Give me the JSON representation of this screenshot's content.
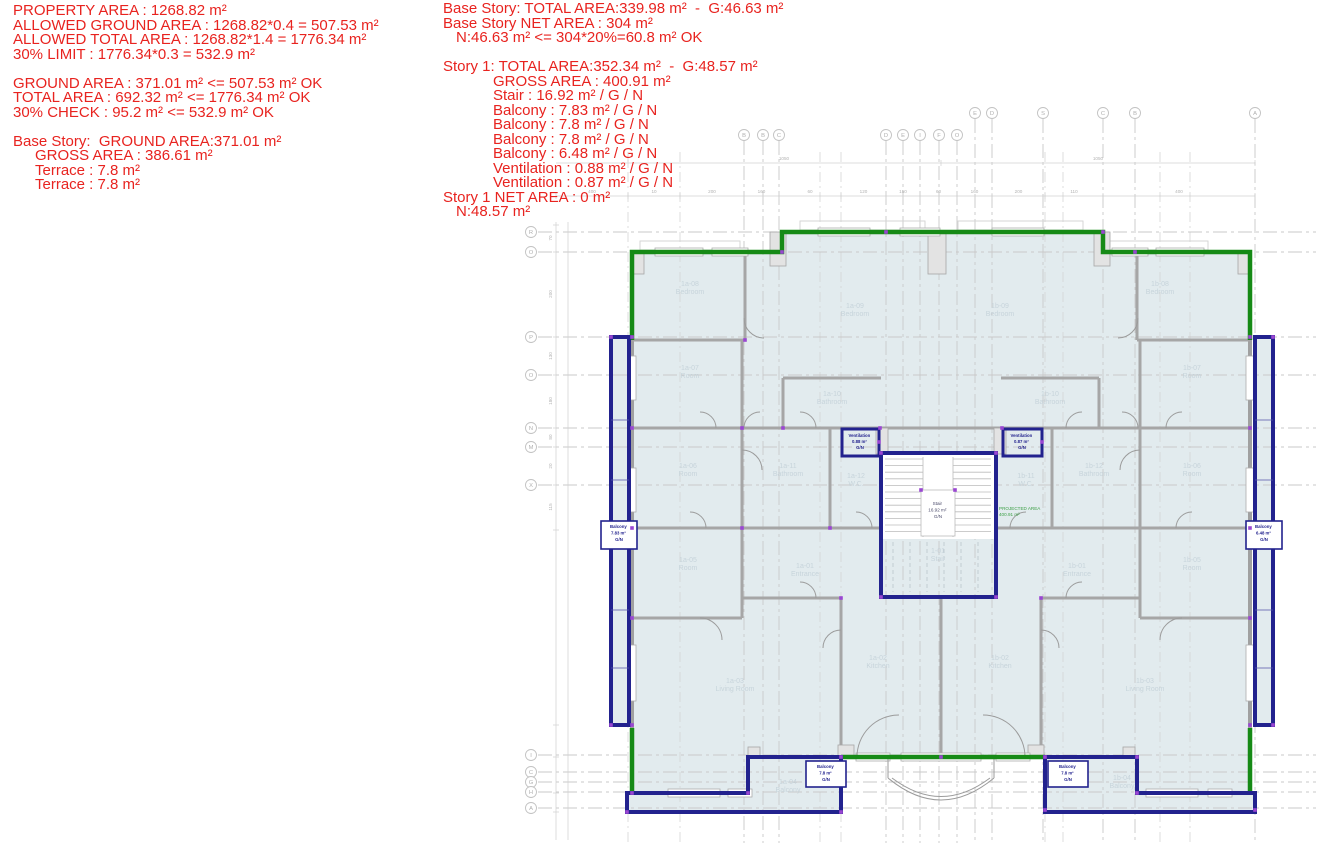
{
  "colors": {
    "red_text": "#e8231f",
    "outline_green": "#168a16",
    "outline_navy": "#22228e",
    "room_fill": "#e2ebee",
    "wall_gray": "#a3a3a3",
    "grid_gray": "#c9c9c9",
    "room_label": "#c7d4db",
    "grip_purple": "#9a46d2",
    "projected_green": "#3da047"
  },
  "calc_left": {
    "lines": [
      {
        "t": "PROPERTY AREA : 1268.82 m²",
        "i": 0
      },
      {
        "t": "ALLOWED GROUND AREA : 1268.82*0.4 = 507.53 m²",
        "i": 0
      },
      {
        "t": "ALLOWED TOTAL AREA : 1268.82*1.4 = 1776.34 m²",
        "i": 0
      },
      {
        "t": "30% LIMIT : 1776.34*0.3 = 532.9 m²",
        "i": 0
      },
      {
        "t": "",
        "i": 0
      },
      {
        "t": "GROUND AREA : 371.01 m² <= 507.53 m² OK",
        "i": 0
      },
      {
        "t": "TOTAL AREA : 692.32 m² <= 1776.34 m² OK",
        "i": 0
      },
      {
        "t": "30% CHECK : 95.2 m² <= 532.9 m² OK",
        "i": 0
      },
      {
        "t": "",
        "i": 0
      },
      {
        "t": "Base Story:  GROUND AREA:371.01 m²",
        "i": 0
      },
      {
        "t": "GROSS AREA : 386.61 m²",
        "i": 1
      },
      {
        "t": "Terrace : 7.8 m²",
        "i": 1
      },
      {
        "t": "Terrace : 7.8 m²",
        "i": 1
      }
    ]
  },
  "calc_right": {
    "lines": [
      {
        "t": "Base Story: TOTAL AREA:339.98 m²  -  G:46.63 m²",
        "i": 0
      },
      {
        "t": "Base Story NET AREA : 304 m²",
        "i": 0
      },
      {
        "t": "N:46.63 m² <= 304*20%=60.8 m² OK",
        "i": 1
      },
      {
        "t": "",
        "i": 0
      },
      {
        "t": "Story 1: TOTAL AREA:352.34 m²  -  G:48.57 m²",
        "i": 0
      },
      {
        "t": "GROSS AREA : 400.91 m²",
        "i": 2
      },
      {
        "t": "Stair : 16.92 m² / G / N",
        "i": 2
      },
      {
        "t": "Balcony : 7.83 m² / G / N",
        "i": 2
      },
      {
        "t": "Balcony : 7.8 m² / G / N",
        "i": 2
      },
      {
        "t": "Balcony : 7.8 m² / G / N",
        "i": 2
      },
      {
        "t": "Balcony : 6.48 m² / G / N",
        "i": 2
      },
      {
        "t": "Ventilation : 0.88 m² / G / N",
        "i": 2
      },
      {
        "t": "Ventilation : 0.87 m² / G / N",
        "i": 2
      },
      {
        "t": "Story 1 NET AREA : 0 m²",
        "i": 0
      },
      {
        "t": "N:48.57 m²",
        "i": 1
      }
    ]
  },
  "plan": {
    "grid": {
      "top_upper": [
        "E",
        "D",
        "S",
        "C",
        "B",
        "A"
      ],
      "top_lower": [
        "B",
        "B",
        "C",
        "D",
        "E",
        "I",
        "F",
        "O"
      ],
      "left": [
        "R",
        "O",
        "P",
        "O",
        "N",
        "M",
        "X",
        "I",
        "C",
        "G",
        "H",
        "A"
      ],
      "dim_top_main": [
        "400",
        "10",
        "200",
        "160",
        "60",
        "120",
        "150",
        "60",
        "160",
        "200",
        "110",
        "400"
      ],
      "dim_top_overall": [
        "1050",
        "1050"
      ],
      "dim_left": [
        "70",
        "200",
        "130",
        "180",
        "80",
        "20",
        "115"
      ]
    },
    "rooms": [
      {
        "id": "1a-08",
        "name": "Bedroom"
      },
      {
        "id": "1a-09",
        "name": "Bedroom"
      },
      {
        "id": "1a-07",
        "name": "Room"
      },
      {
        "id": "1a-10",
        "name": "Bathroom"
      },
      {
        "id": "1a-06",
        "name": "Room"
      },
      {
        "id": "1a-11",
        "name": "Bathroom"
      },
      {
        "id": "1a-12",
        "name": "W.C."
      },
      {
        "id": "1a-05",
        "name": "Room"
      },
      {
        "id": "1a-01",
        "name": "Entrance"
      },
      {
        "id": "1a-03",
        "name": "Living Room"
      },
      {
        "id": "1a-02",
        "name": "Kitchen"
      },
      {
        "id": "1a-04",
        "name": "Balcony"
      },
      {
        "id": "1b-08",
        "name": "Bedroom"
      },
      {
        "id": "1b-09",
        "name": "Bedroom"
      },
      {
        "id": "1b-07",
        "name": "Room"
      },
      {
        "id": "1b-10",
        "name": "Bathroom"
      },
      {
        "id": "1b-06",
        "name": "Room"
      },
      {
        "id": "1b-12",
        "name": "Bathroom"
      },
      {
        "id": "1b-11",
        "name": "W.C."
      },
      {
        "id": "1b-05",
        "name": "Room"
      },
      {
        "id": "1b-01",
        "name": "Entrance"
      },
      {
        "id": "1b-03",
        "name": "Living Room"
      },
      {
        "id": "1b-02",
        "name": "Kitchen"
      },
      {
        "id": "1b-04",
        "name": "Balcony"
      },
      {
        "id": "1-01",
        "name": "Stair"
      }
    ],
    "labels": {
      "stair_box": {
        "l1": "Stair",
        "l2": "16.92 m²",
        "l3": "G/N"
      },
      "vent_left": {
        "l1": "Ventilation",
        "l2": "0.88 m²",
        "l3": "G/N"
      },
      "vent_right": {
        "l1": "Ventilation",
        "l2": "0.87 m²",
        "l3": "G/N"
      },
      "balcony_strip_left": {
        "l1": "Balcony",
        "l2": "7.83 m²",
        "l3": "G/N"
      },
      "balcony_strip_right": {
        "l1": "Balcony",
        "l2": "6.48 m²",
        "l3": "G/N"
      },
      "terrace_left": {
        "l1": "Balcony",
        "l2": "7.8 m²",
        "l3": "G/N"
      },
      "terrace_right": {
        "l1": "Balcony",
        "l2": "7.8 m²",
        "l3": "G/N"
      },
      "projected": {
        "l1": "PROJECTED AREA",
        "l2": "400.91 m²"
      }
    }
  }
}
